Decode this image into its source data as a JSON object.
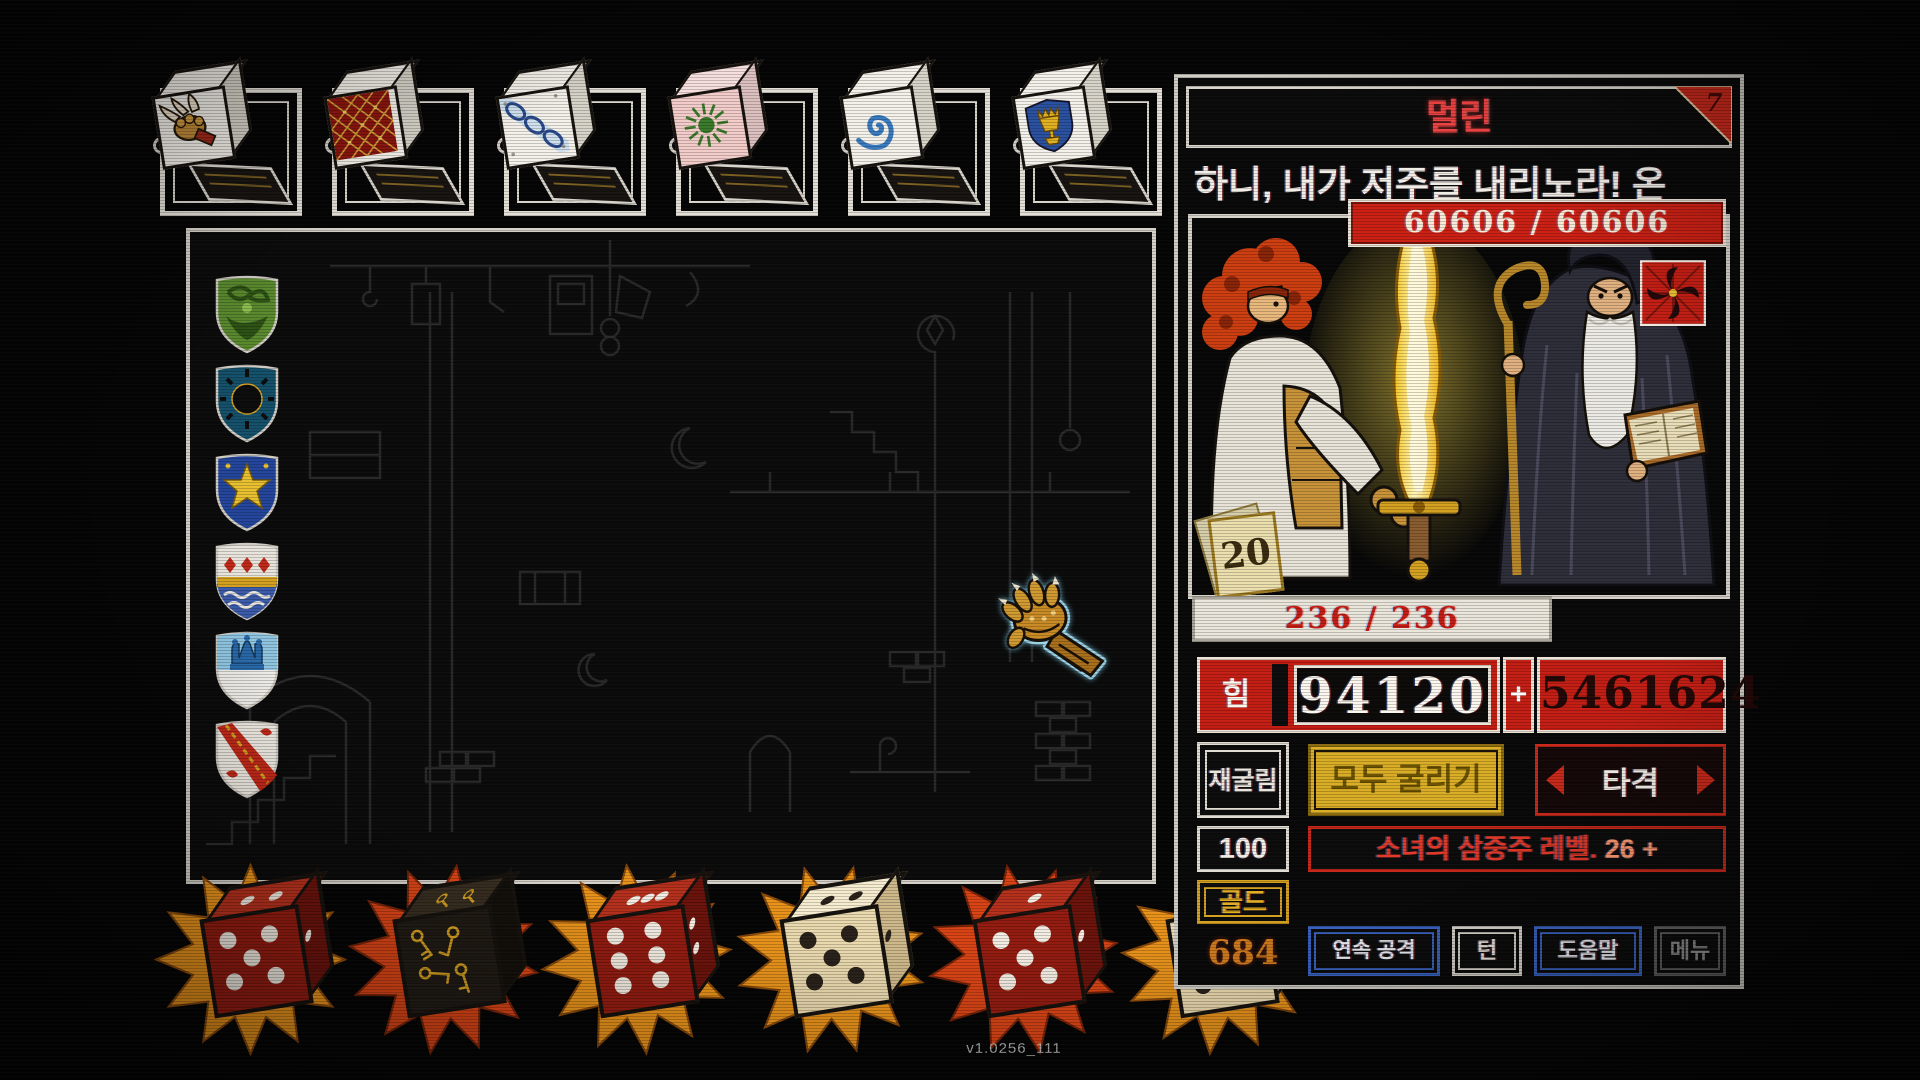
{
  "window": {
    "version_label": "v1.0256_111"
  },
  "colors": {
    "accent_red": "#c8281a",
    "gold": "#d9ad25",
    "blue": "#3a64c4",
    "panel_border": "#cfccc4"
  },
  "top_dice_slots": [
    {
      "icon": "claw-fist-die"
    },
    {
      "icon": "gold-lattice-die"
    },
    {
      "icon": "blue-chain-die"
    },
    {
      "icon": "green-sunburst-die"
    },
    {
      "icon": "blue-spiral-die"
    },
    {
      "icon": "chalice-shield-die"
    }
  ],
  "board": {
    "shields": [
      {
        "icon": "green-foliage-shield"
      },
      {
        "icon": "black-sun-shield"
      },
      {
        "icon": "gold-star-shield"
      },
      {
        "icon": "red-diamond-banded-shield"
      },
      {
        "icon": "blue-crown-shield"
      },
      {
        "icon": "red-bend-chain-shield"
      }
    ],
    "cursor_icon": "gauntlet-cursor"
  },
  "enemy_panel": {
    "title": "멀린",
    "corner_badge": "7",
    "dialogue": "하니, 내가 저주를 내리노라! 온",
    "enemy_hp": "60606 / 60606",
    "status_icon": "red-pinwheel-curse",
    "die_value": "20",
    "player_hp": "236 / 236",
    "strength_label": "힘",
    "strength_value": "94120",
    "plus_sign": "+",
    "strength_bonus": "5461624",
    "reroll_label": "재굴림",
    "reroll_count": "100",
    "roll_all_label": "모두 굴리기",
    "strike_label": "타격",
    "skill_text": "소녀의 삼중주 레벨.",
    "skill_value": "26 +",
    "gold_label": "골드",
    "gold_value": "684",
    "combo_label": "연속 공격",
    "turn_label": "턴",
    "help_label": "도움말",
    "menu_label": "메뉴"
  },
  "bottom_dice": [
    {
      "icon": "red-pip-die",
      "face": "5"
    },
    {
      "icon": "black-key-die",
      "face": "keys"
    },
    {
      "icon": "red-pip-die",
      "face": "6"
    },
    {
      "icon": "cream-pip-die",
      "face": "5"
    },
    {
      "icon": "red-pip-die",
      "face": "5"
    },
    {
      "icon": "cream-pip-die",
      "face": "6"
    }
  ]
}
